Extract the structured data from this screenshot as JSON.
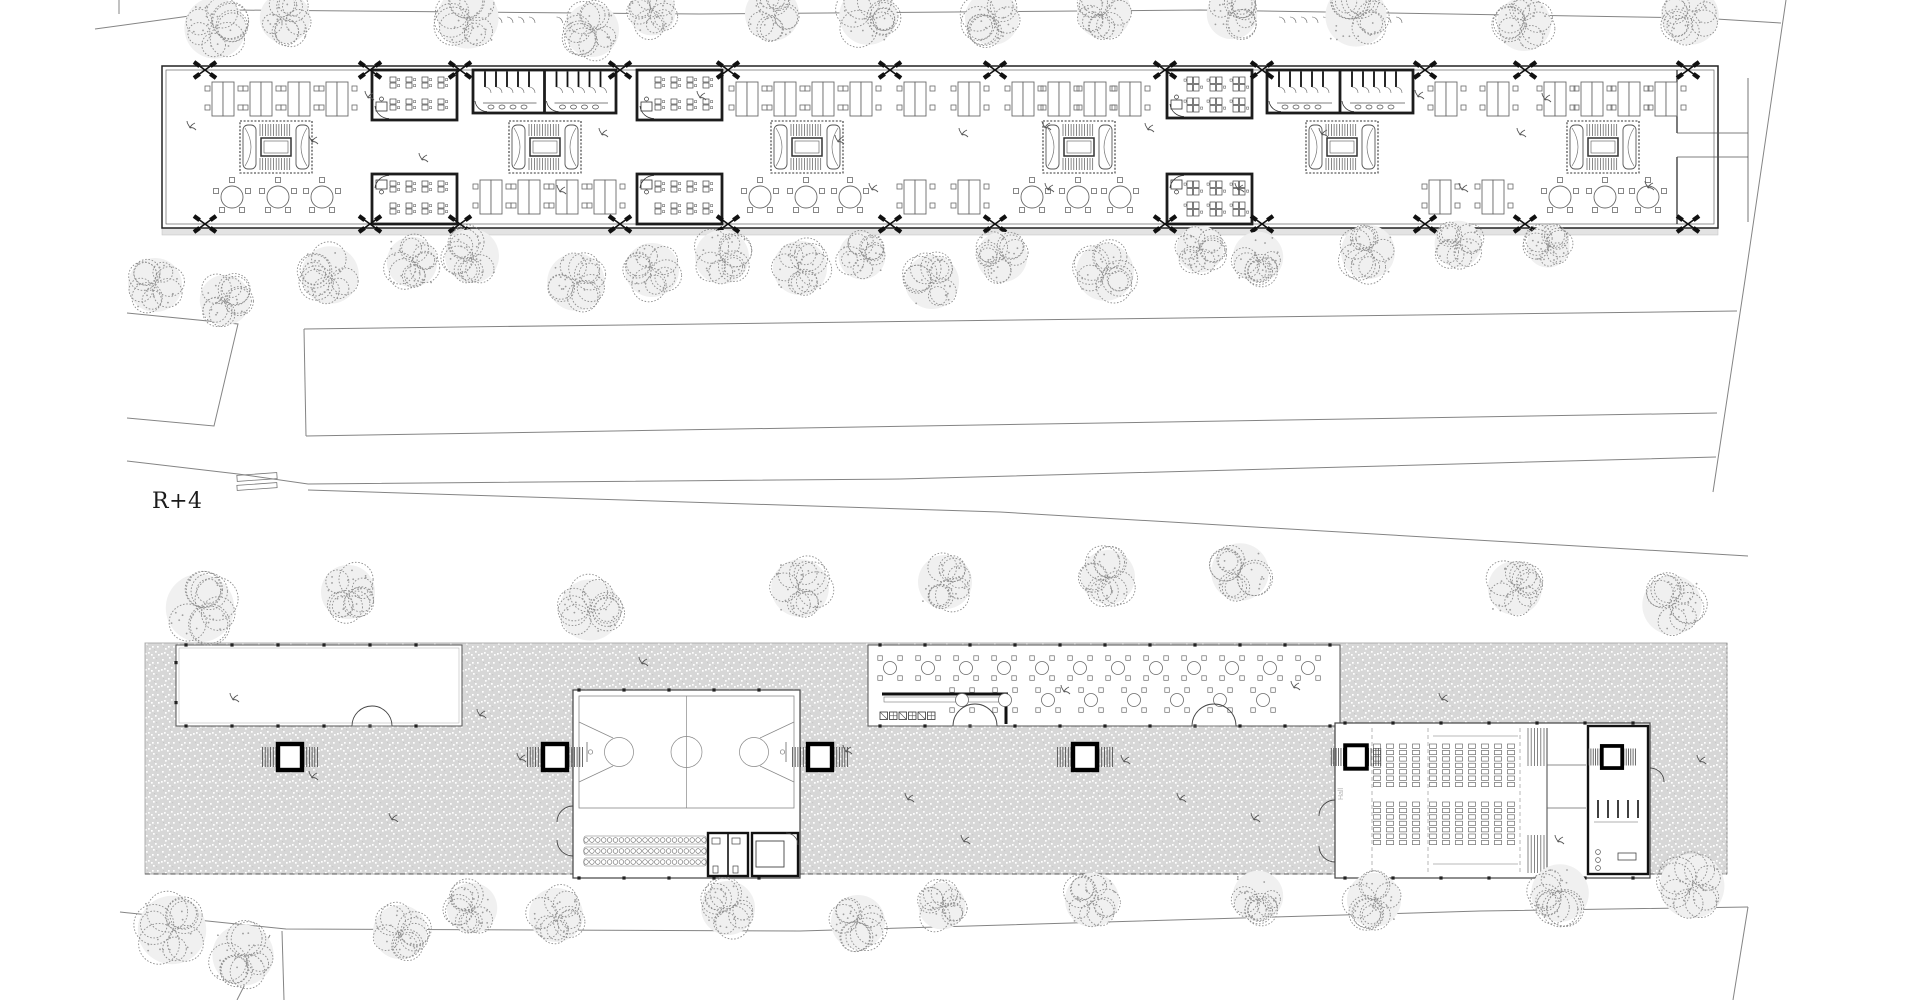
{
  "meta": {
    "level_label": "R+4",
    "hall_label": "Hall"
  },
  "colors": {
    "bg": "#ffffff",
    "ink": "#1c1c1c",
    "wall": "#2a2a2a",
    "mid": "#6a6a6a",
    "light": "#9a9a9a",
    "faint": "#bdbdbd",
    "terrace": "#d7d7d7",
    "slab": "#e3e3e3",
    "tree": "#8d8d8d",
    "tree_fill": "#f0f0f0",
    "hall_text": "#b3b3b3"
  },
  "site": {
    "lines": [
      {
        "pts": [
          [
            95,
            29
          ],
          [
            233,
            10
          ],
          [
            700,
            14
          ],
          [
            1200,
            10
          ],
          [
            1700,
            18
          ],
          [
            1781,
            23
          ]
        ]
      },
      {
        "pts": [
          [
            119,
            0
          ],
          [
            119,
            14
          ]
        ]
      },
      {
        "pts": [
          [
            1786,
            0
          ],
          [
            1745,
            280
          ],
          [
            1713,
            492
          ]
        ]
      },
      {
        "pts": [
          [
            127,
            313
          ],
          [
            238,
            324
          ],
          [
            214,
            426
          ],
          [
            127,
            418
          ]
        ]
      },
      {
        "pts": [
          [
            304,
            329
          ],
          [
            1737,
            311
          ]
        ]
      },
      {
        "pts": [
          [
            306,
            436
          ],
          [
            1717,
            413
          ]
        ]
      },
      {
        "pts": [
          [
            304,
            329
          ],
          [
            306,
            436
          ]
        ]
      },
      {
        "pts": [
          [
            127,
            461
          ],
          [
            238,
            474
          ],
          [
            308,
            484
          ],
          [
            900,
            479
          ],
          [
            1716,
            457
          ]
        ]
      },
      {
        "pts": [
          [
            308,
            490
          ],
          [
            1000,
            512
          ],
          [
            1748,
            556
          ]
        ]
      },
      {
        "pts": [
          [
            120,
            912
          ],
          [
            286,
            929
          ],
          [
            800,
            931
          ],
          [
            1480,
            911
          ],
          [
            1748,
            907
          ]
        ]
      },
      {
        "pts": [
          [
            1748,
            907
          ],
          [
            1733,
            1000
          ]
        ]
      },
      {
        "pts": [
          [
            270,
            935
          ],
          [
            237,
            1000
          ]
        ]
      },
      {
        "pts": [
          [
            282,
            931
          ],
          [
            284,
            1000
          ]
        ]
      }
    ],
    "crosswalk": [
      [
        237,
        474,
        40,
        6
      ],
      [
        237,
        484,
        40,
        5
      ]
    ]
  },
  "trees": [
    [
      215,
      28,
      34
    ],
    [
      285,
      18,
      28
    ],
    [
      468,
      18,
      34
    ],
    [
      592,
      30,
      30
    ],
    [
      652,
      12,
      26
    ],
    [
      772,
      14,
      30
    ],
    [
      868,
      16,
      32
    ],
    [
      992,
      18,
      30
    ],
    [
      1104,
      12,
      30
    ],
    [
      1232,
      14,
      28
    ],
    [
      1356,
      16,
      34
    ],
    [
      1524,
      24,
      30
    ],
    [
      1690,
      16,
      32
    ],
    [
      155,
      285,
      30
    ],
    [
      225,
      300,
      28
    ],
    [
      330,
      275,
      32
    ],
    [
      412,
      262,
      28
    ],
    [
      472,
      256,
      30
    ],
    [
      576,
      282,
      32
    ],
    [
      652,
      270,
      30
    ],
    [
      722,
      257,
      30
    ],
    [
      800,
      268,
      30
    ],
    [
      862,
      256,
      26
    ],
    [
      932,
      282,
      30
    ],
    [
      1002,
      257,
      28
    ],
    [
      1105,
      272,
      32
    ],
    [
      1200,
      249,
      26
    ],
    [
      1258,
      257,
      28
    ],
    [
      1368,
      252,
      30
    ],
    [
      1458,
      244,
      26
    ],
    [
      1548,
      246,
      24
    ],
    [
      200,
      608,
      38
    ],
    [
      348,
      592,
      30
    ],
    [
      590,
      610,
      34
    ],
    [
      800,
      588,
      32
    ],
    [
      945,
      582,
      30
    ],
    [
      1108,
      577,
      30
    ],
    [
      1240,
      572,
      32
    ],
    [
      1515,
      588,
      30
    ],
    [
      1672,
      605,
      33
    ],
    [
      172,
      930,
      38
    ],
    [
      243,
      955,
      34
    ],
    [
      400,
      932,
      30
    ],
    [
      472,
      908,
      28
    ],
    [
      556,
      915,
      30
    ],
    [
      728,
      908,
      30
    ],
    [
      858,
      922,
      30
    ],
    [
      942,
      906,
      26
    ],
    [
      1092,
      900,
      30
    ],
    [
      1258,
      896,
      28
    ],
    [
      1374,
      900,
      30
    ],
    [
      1560,
      893,
      32
    ],
    [
      1692,
      886,
      36
    ]
  ],
  "upper_plan": {
    "outline": {
      "x": 162,
      "y": 66,
      "w": 1556,
      "h": 162,
      "inset": 4
    },
    "slab": {
      "x": 162,
      "y": 228,
      "w": 1556,
      "h": 7
    },
    "end": {
      "wall_x": 1677,
      "strip_x": 1748,
      "gap_y1": 133,
      "gap_y2": 157
    },
    "marks_x": [
      205,
      370,
      460,
      620,
      728,
      890,
      995,
      1165,
      1262,
      1425,
      1525,
      1688
    ],
    "marks_top_y": 70,
    "marks_bot_y": 224,
    "cores": {
      "x": [
        276,
        545,
        807,
        1079,
        1342,
        1603
      ],
      "cy": 147,
      "w": 72,
      "h": 52
    },
    "desks": {
      "top_y": 99,
      "bot_y": 197,
      "top_x": [
        224,
        262,
        300,
        338,
        748,
        786,
        824,
        862,
        916,
        970,
        1024,
        1060,
        1096,
        1131,
        1447,
        1499,
        1556,
        1593,
        1630,
        1667
      ],
      "bot_x": [
        492,
        530,
        568,
        606,
        916,
        970,
        1441,
        1494
      ]
    },
    "tables": {
      "y": 197,
      "x": [
        232,
        278,
        322,
        760,
        806,
        850,
        1032,
        1078,
        1120,
        1560,
        1605,
        1648
      ]
    },
    "classrooms": [
      {
        "x": 372,
        "y": 70,
        "w": 85,
        "h": 50,
        "kind": "rows",
        "attach": "top"
      },
      {
        "x": 372,
        "y": 174,
        "w": 85,
        "h": 50,
        "kind": "rows",
        "attach": "bottom"
      },
      {
        "x": 637,
        "y": 70,
        "w": 85,
        "h": 50,
        "kind": "rows",
        "attach": "top"
      },
      {
        "x": 637,
        "y": 174,
        "w": 85,
        "h": 50,
        "kind": "rows",
        "attach": "bottom"
      },
      {
        "x": 1167,
        "y": 70,
        "w": 85,
        "h": 48,
        "kind": "groups",
        "attach": "top"
      },
      {
        "x": 1167,
        "y": 174,
        "w": 85,
        "h": 50,
        "kind": "groups",
        "attach": "bottom"
      }
    ],
    "wc": [
      {
        "x": 473,
        "y": 70,
        "w": 143,
        "h": 43
      },
      {
        "x": 1267,
        "y": 70,
        "w": 146,
        "h": 43
      }
    ],
    "sprigs": [
      [
        190,
        128
      ],
      [
        312,
        142
      ],
      [
        368,
        98
      ],
      [
        422,
        160
      ],
      [
        560,
        192
      ],
      [
        602,
        135
      ],
      [
        700,
        98
      ],
      [
        838,
        142
      ],
      [
        872,
        190
      ],
      [
        962,
        135
      ],
      [
        1048,
        190
      ],
      [
        1148,
        130
      ],
      [
        1238,
        190
      ],
      [
        1322,
        135
      ],
      [
        1418,
        97
      ],
      [
        1462,
        190
      ],
      [
        1520,
        135
      ],
      [
        1545,
        100
      ],
      [
        1648,
        188
      ],
      [
        1045,
        128
      ]
    ]
  },
  "lower_plan": {
    "terrace": {
      "x": 145,
      "y": 643,
      "w": 1582,
      "h": 231
    },
    "courtyard": {
      "x": 176,
      "y": 645,
      "w": 286,
      "h": 81,
      "door_cx": 372
    },
    "cafe": {
      "x": 868,
      "y": 645,
      "w": 472,
      "h": 81,
      "doors_cx": [
        975,
        1214
      ],
      "counter": {
        "x": 882,
        "y": 694,
        "len": 126,
        "drop_x": 1006,
        "drop_len": 30
      },
      "appliances": {
        "x": 880,
        "y": 712,
        "n": 6,
        "s": 9.5
      },
      "tables": {
        "top_y": 668,
        "bot_y": 700,
        "top_x": [
          890,
          928,
          966,
          1004,
          1042,
          1080,
          1118,
          1156,
          1194,
          1232,
          1270,
          1308
        ],
        "bot_x": [
          962,
          1005,
          1048,
          1091,
          1134,
          1177,
          1220,
          1263
        ]
      }
    },
    "court": {
      "x": 573,
      "y": 690,
      "w": 227,
      "h": 188,
      "field": {
        "x": 579,
        "y": 696,
        "w": 215,
        "h": 112
      },
      "bench_rows_y": [
        840,
        851,
        862
      ],
      "bench_x0": 586,
      "bench_x1": 704,
      "rooms": [
        {
          "x": 708,
          "y": 833,
          "w": 40,
          "h": 43
        },
        {
          "x": 752,
          "y": 833,
          "w": 46,
          "h": 43
        }
      ]
    },
    "hall": {
      "x": 1335,
      "y": 723,
      "w": 315,
      "h": 155,
      "dash_x": [
        1372,
        1428,
        1520
      ],
      "seatsA": {
        "x0": 1377,
        "cols": 4,
        "colw": 13
      },
      "seatsB": {
        "x0": 1433,
        "cols": 7,
        "colw": 13
      },
      "bank_y": [
        744,
        802
      ],
      "rows": 7,
      "rowh": 6.4,
      "stage": {
        "x0": 1528,
        "x1": 1546,
        "wall_x": 1547
      },
      "service": {
        "x": 1588,
        "y": 726,
        "w": 60,
        "h": 148
      },
      "core_xy": [
        1356,
        757
      ],
      "service_core_xy": [
        1612,
        757
      ],
      "label_xy": [
        1343,
        800
      ]
    },
    "cores": [
      [
        290,
        757
      ],
      [
        555,
        757
      ],
      [
        820,
        757
      ],
      [
        1085,
        757
      ]
    ],
    "sprigs": [
      [
        233,
        700
      ],
      [
        312,
        778
      ],
      [
        392,
        820
      ],
      [
        480,
        716
      ],
      [
        642,
        664
      ],
      [
        846,
        752
      ],
      [
        908,
        800
      ],
      [
        1064,
        692
      ],
      [
        1124,
        762
      ],
      [
        1254,
        820
      ],
      [
        1442,
        700
      ],
      [
        1558,
        842
      ],
      [
        1700,
        762
      ],
      [
        1294,
        688
      ],
      [
        964,
        842
      ],
      [
        520,
        760
      ],
      [
        1180,
        800
      ]
    ]
  }
}
